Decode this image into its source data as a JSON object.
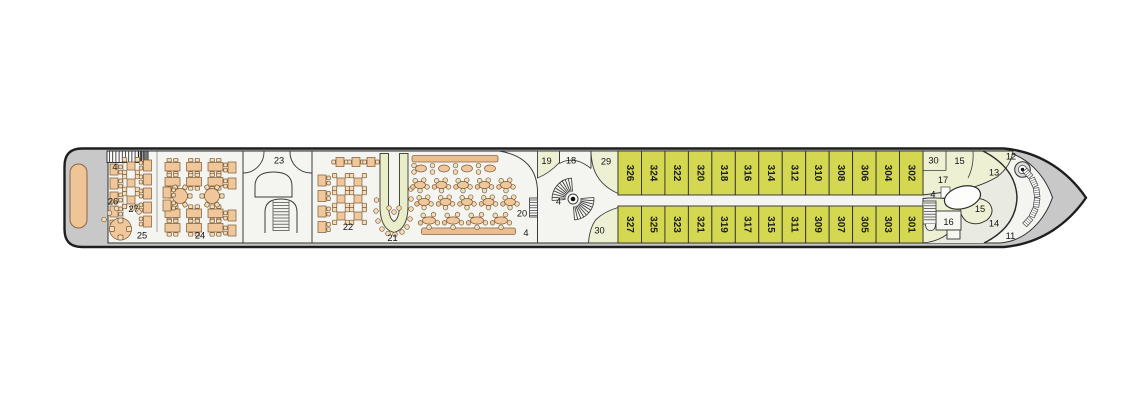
{
  "plan": {
    "name": "ship-deck-plan",
    "cabins": {
      "upper_row": [
        "326",
        "324",
        "322",
        "320",
        "318",
        "316",
        "314",
        "312",
        "310",
        "308",
        "306",
        "304",
        "302"
      ],
      "lower_row": [
        "327",
        "325",
        "323",
        "321",
        "319",
        "317",
        "315",
        "311",
        "309",
        "307",
        "305",
        "303",
        "301"
      ]
    },
    "area_labels": [
      {
        "name": "stairs-aft",
        "text": "4",
        "x": 115,
        "y": 170
      },
      {
        "name": "area-26",
        "text": "26",
        "x": 113,
        "y": 204.5
      },
      {
        "name": "area-27",
        "text": "27",
        "x": 133.5,
        "y": 212
      },
      {
        "name": "area-25",
        "text": "25",
        "x": 142,
        "y": 238.5
      },
      {
        "name": "area-24",
        "text": "24",
        "x": 200,
        "y": 238.5
      },
      {
        "name": "area-23",
        "text": "23",
        "x": 279,
        "y": 163.5
      },
      {
        "name": "area-22",
        "text": "22",
        "x": 348,
        "y": 230
      },
      {
        "name": "area-21",
        "text": "21",
        "x": 392.5,
        "y": 241
      },
      {
        "name": "area-20",
        "text": "20",
        "x": 522,
        "y": 216.5
      },
      {
        "name": "stairs-lounge",
        "text": "4",
        "x": 526,
        "y": 236
      },
      {
        "name": "area-19",
        "text": "19",
        "x": 546.5,
        "y": 164
      },
      {
        "name": "area-18",
        "text": "18",
        "x": 571,
        "y": 163.5
      },
      {
        "name": "stairs-atrium",
        "text": "4",
        "x": 558.5,
        "y": 204.5
      },
      {
        "name": "area-29",
        "text": "29",
        "x": 606,
        "y": 164.5
      },
      {
        "name": "area-30-midship",
        "text": "30",
        "x": 599.5,
        "y": 233.5
      },
      {
        "name": "area-30-forward",
        "text": "30",
        "x": 933.5,
        "y": 163.5
      },
      {
        "name": "area-15-forward-top",
        "text": "15",
        "x": 959.5,
        "y": 164
      },
      {
        "name": "area-13",
        "text": "13",
        "x": 994,
        "y": 175.5
      },
      {
        "name": "area-12",
        "text": "12",
        "x": 1011,
        "y": 159.5
      },
      {
        "name": "area-17",
        "text": "17",
        "x": 943,
        "y": 183
      },
      {
        "name": "stairs-bow",
        "text": "4",
        "x": 933,
        "y": 197.5
      },
      {
        "name": "area-15-forward-mid",
        "text": "15",
        "x": 980,
        "y": 212
      },
      {
        "name": "area-16",
        "text": "16",
        "x": 948.5,
        "y": 225
      },
      {
        "name": "area-14",
        "text": "14",
        "x": 994,
        "y": 226.5
      },
      {
        "name": "area-11",
        "text": "11",
        "x": 1010.5,
        "y": 239
      }
    ],
    "colors": {
      "hull_fill": "#c8c8c8",
      "deck_fill": "#f4f4f0",
      "cabin_fill": "#d4d850",
      "room_fill": "#edf0d2",
      "inner_area_fill": "#e9eae1",
      "furniture_fill": "#efc79b",
      "furniture_light": "#f3dcba",
      "chair_olive": "#e7e4c2",
      "counter_fill": "#e9bf92",
      "furniture_stroke": "#7d5a36",
      "outline_dark": "#1e1e1e",
      "wall": "#3b3b3b",
      "label_color": "#141414"
    }
  }
}
